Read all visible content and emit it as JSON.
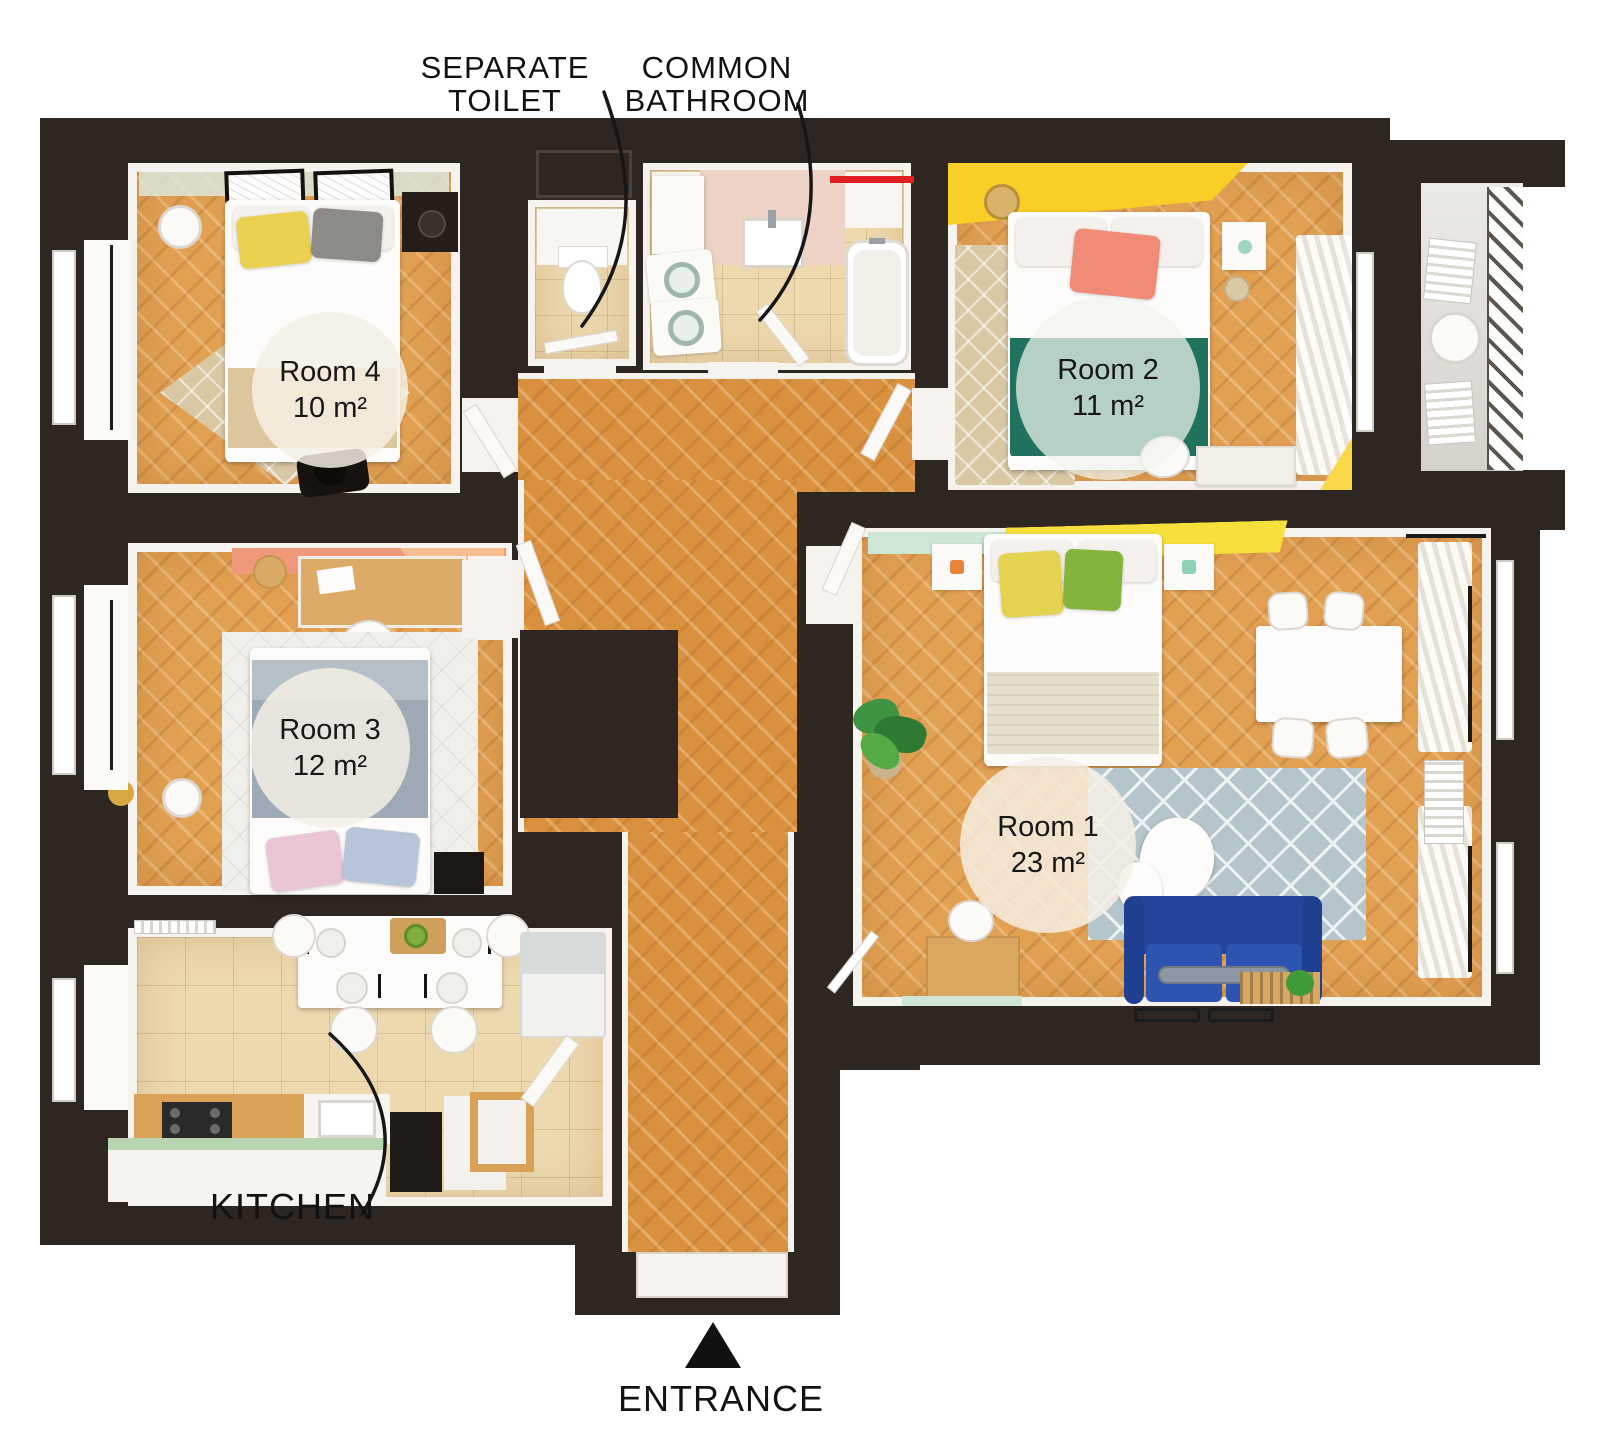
{
  "callouts": {
    "separate_toilet": {
      "line1": "SEPARATE",
      "line2": "TOILET"
    },
    "common_bathroom": {
      "line1": "COMMON",
      "line2": "BATHROOM"
    },
    "kitchen": "KITCHEN",
    "entrance": "ENTRANCE"
  },
  "rooms": [
    {
      "name": "Room 4",
      "area": "10 m²"
    },
    {
      "name": "Room 2",
      "area": "11 m²"
    },
    {
      "name": "Room 3",
      "area": "12 m²"
    },
    {
      "name": "Room 1",
      "area": "23 m²"
    }
  ],
  "colors": {
    "wall": "#2d2621",
    "hall_wood": "#d9913f",
    "room_wood": "#e2a053",
    "tile": "#edd9ae",
    "accent_yellow": "#f8d532",
    "accent_coral": "#f0997a",
    "teal_blanket": "#20725f",
    "sofa_blue": "#2b50a8",
    "rug_gray": "#b4c6cb",
    "towel_red": "#e02020",
    "mint": "#cde6d6"
  }
}
